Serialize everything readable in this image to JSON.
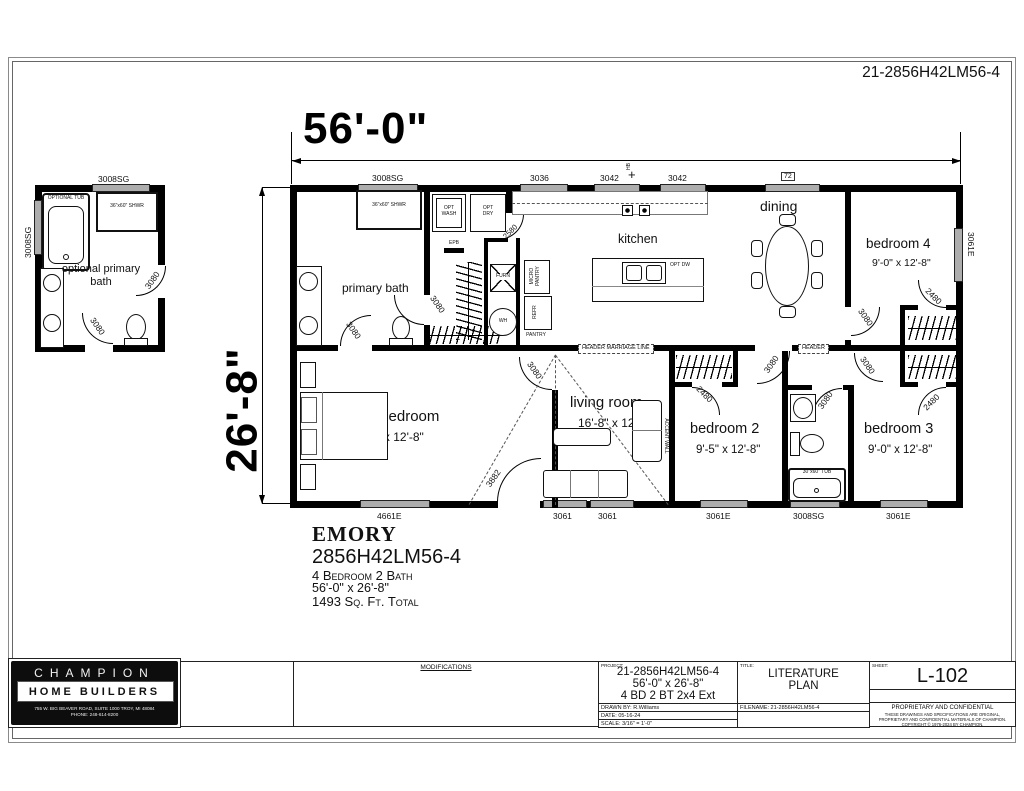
{
  "sheet": {
    "number": "21-2856H42LM56-4"
  },
  "dims": {
    "width": "56'-0\"",
    "height": "26'-8\""
  },
  "opt_bath": {
    "label": "optional primary bath",
    "tub": "OPTIONAL TUB",
    "shower": "36\"x60\" SHWR",
    "window_top": "3008SG",
    "window_left": "3008SG",
    "door_bottom": "3080",
    "door_right": "3080"
  },
  "plan": {
    "windows_top": [
      "3008SG",
      "3036",
      "3042",
      "3042",
      "72"
    ],
    "hb": "HB",
    "window_right": "3061E",
    "windows_bottom": [
      "4661E",
      "3061",
      "3061",
      "3061E",
      "3008SG",
      "3061E"
    ]
  },
  "rooms": {
    "primary_bath": "primary bath",
    "kitchen": "kitchen",
    "dining": "dining",
    "bedroom4": {
      "name": "bedroom 4",
      "dims": "9'-0\" x 12'-8\""
    },
    "primary_bedroom": {
      "name": "primary bedroom",
      "dims": "13'-9\" x 12'-8\""
    },
    "living": {
      "name": "living room",
      "dims": "16'-8\" x 12'-8\""
    },
    "bedroom2": {
      "name": "bedroom 2",
      "dims": "9'-5\" x 12'-8\""
    },
    "bedroom3": {
      "name": "bedroom 3",
      "dims": "9'-0\" x 12'-8\""
    }
  },
  "fx": {
    "opt_wash": "OPT WASH",
    "opt_dry": "OPT DRY",
    "epb": "EPB",
    "furn": "FURN",
    "wh": "WH",
    "micro_pantry": "MICRO PANTRY",
    "refr": "REFR",
    "pantry": "PANTRY",
    "opt_dw": "OPT DW",
    "shower": "36\"x60\" SHWR",
    "tub": "30\"x60\" TUB",
    "accent": "ACCENT WALL"
  },
  "hdr": {
    "marriage": "HEADER MARRIAGE LINE",
    "header": "HEADER"
  },
  "doors": {
    "d3080": "3080",
    "d2480": "2480",
    "d2580": "2580",
    "d3882": "3882"
  },
  "emory": {
    "name": "EMORY",
    "model": "2856H42LM56-4",
    "line3": "4 Bedroom 2 Bath",
    "line4": "56'-0\" x 26'-8\"",
    "line5": "1493 Sq. Ft. Total"
  },
  "tb": {
    "modifications": "MODIFICATIONS",
    "project_label": "PROJECT:",
    "project1": "21-2856H42LM56-4",
    "project2": "56'-0\" x 26'-8\"",
    "project3": "4 BD 2 BT 2x4 Ext",
    "drawn_by": "DRAWN BY: R.Williams",
    "date": "DATE: 05-16-24",
    "scale": "SCALE: 3/16\" = 1'-0\"",
    "title_label": "TITLE:",
    "title1": "LITERATURE",
    "title2": "PLAN",
    "filename": "FILENAME: 21-2856H42LM56-4",
    "sheet_label": "SHEET:",
    "sheet_number": "L-102",
    "prop1": "PROPRIETARY AND CONFIDENTIAL",
    "prop2": "THESE DRAWINGS AND SPECIFICATIONS ARE ORIGINAL,",
    "prop3": "PROPRIETARY AND CONFIDENTIAL MATERIALS OF CHAMPION.",
    "prop4": "COPYRIGHT © 1976-2024 BY CHAMPION.",
    "logo1": "CHAMPION",
    "logo2": "HOME BUILDERS",
    "addr1": "755 W. BIG BEAVER ROAD, SUITE 1000 TROY, MI 48084",
    "addr2": "PHONE: 248-614-8200"
  }
}
